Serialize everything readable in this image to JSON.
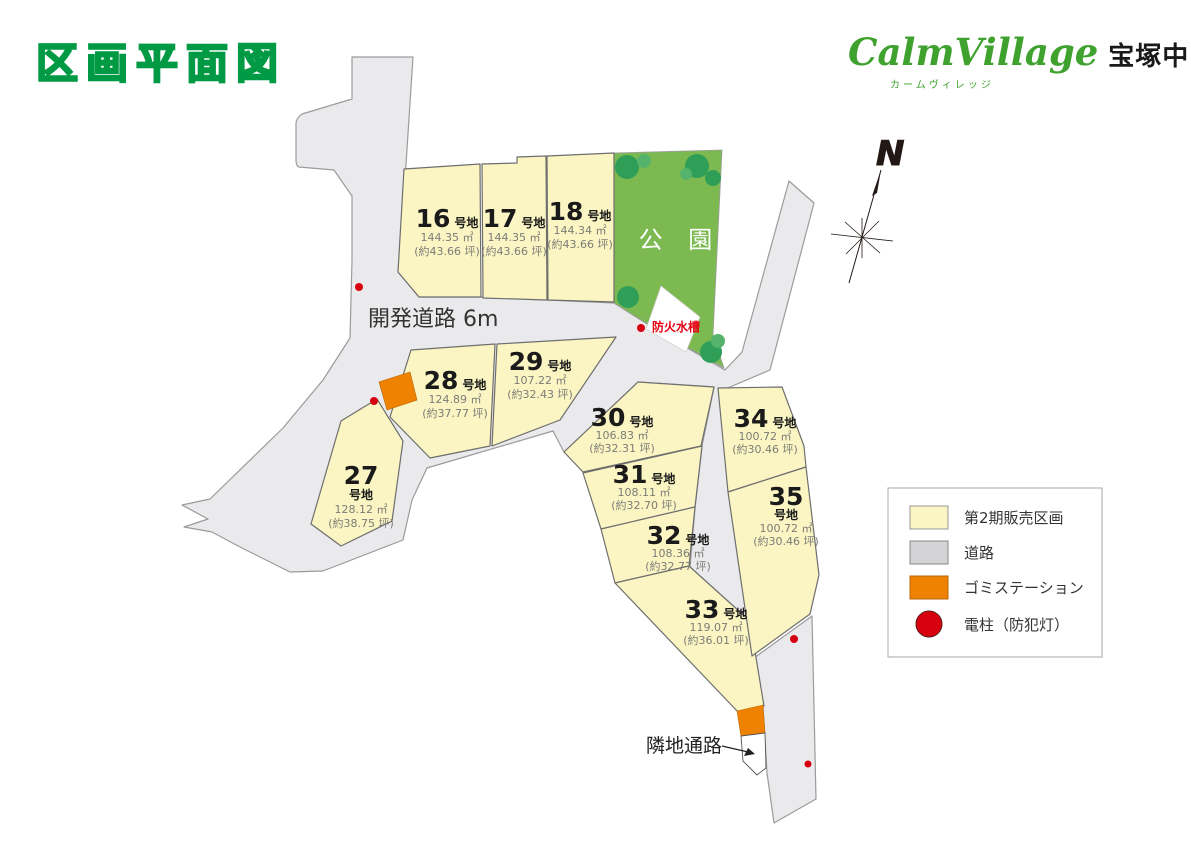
{
  "title": "区画平面図",
  "logo": {
    "name": "CalmVillage",
    "kana": "カームヴィレッジ",
    "project": "宝塚中山寺Ⅱ期"
  },
  "north_label": "N",
  "map": {
    "road_label": "開発道路 6m",
    "park_label": "公 園",
    "fire_tank_label": "防火水槽",
    "passage_label": "隣地通路",
    "lots": [
      {
        "id": "16",
        "suffix": "号地",
        "area": "144.35 ㎡",
        "tsubo": "(約43.66 坪)"
      },
      {
        "id": "17",
        "suffix": "号地",
        "area": "144.35 ㎡",
        "tsubo": "(約43.66 坪)"
      },
      {
        "id": "18",
        "suffix": "号地",
        "area": "144.34 ㎡",
        "tsubo": "(約43.66 坪)"
      },
      {
        "id": "27",
        "suffix": "号地",
        "area": "128.12 ㎡",
        "tsubo": "(約38.75 坪)"
      },
      {
        "id": "28",
        "suffix": "号地",
        "area": "124.89 ㎡",
        "tsubo": "(約37.77 坪)"
      },
      {
        "id": "29",
        "suffix": "号地",
        "area": "107.22 ㎡",
        "tsubo": "(約32.43 坪)"
      },
      {
        "id": "30",
        "suffix": "号地",
        "area": "106.83 ㎡",
        "tsubo": "(約32.31 坪)"
      },
      {
        "id": "31",
        "suffix": "号地",
        "area": "108.11 ㎡",
        "tsubo": "(約32.70 坪)"
      },
      {
        "id": "32",
        "suffix": "号地",
        "area": "108.36 ㎡",
        "tsubo": "(約32.77 坪)"
      },
      {
        "id": "33",
        "suffix": "号地",
        "area": "119.07 ㎡",
        "tsubo": "(約36.01 坪)"
      },
      {
        "id": "34",
        "suffix": "号地",
        "area": "100.72 ㎡",
        "tsubo": "(約30.46 坪)"
      },
      {
        "id": "35",
        "suffix": "号地",
        "area": "100.72 ㎡",
        "tsubo": "(約30.46 坪)"
      }
    ]
  },
  "legend": {
    "items": [
      {
        "label": "第2期販売区画",
        "swatch": "lot-yellow"
      },
      {
        "label": "道路",
        "swatch": "road-gray"
      },
      {
        "label": "ゴミステーション",
        "swatch": "garbage-orange"
      },
      {
        "label": "電柱（防犯灯）",
        "swatch": "pole-red-circle"
      }
    ]
  },
  "colors": {
    "lot_fill": "#faf5c2",
    "road_fill": "#eaeaec",
    "park_fill": "#7cba51",
    "tree_green": "#2f9e57",
    "garbage_orange": "#ef8200",
    "pole_red": "#d7000f",
    "title_green": "#009a44",
    "tank_text_red": "#e60012"
  }
}
